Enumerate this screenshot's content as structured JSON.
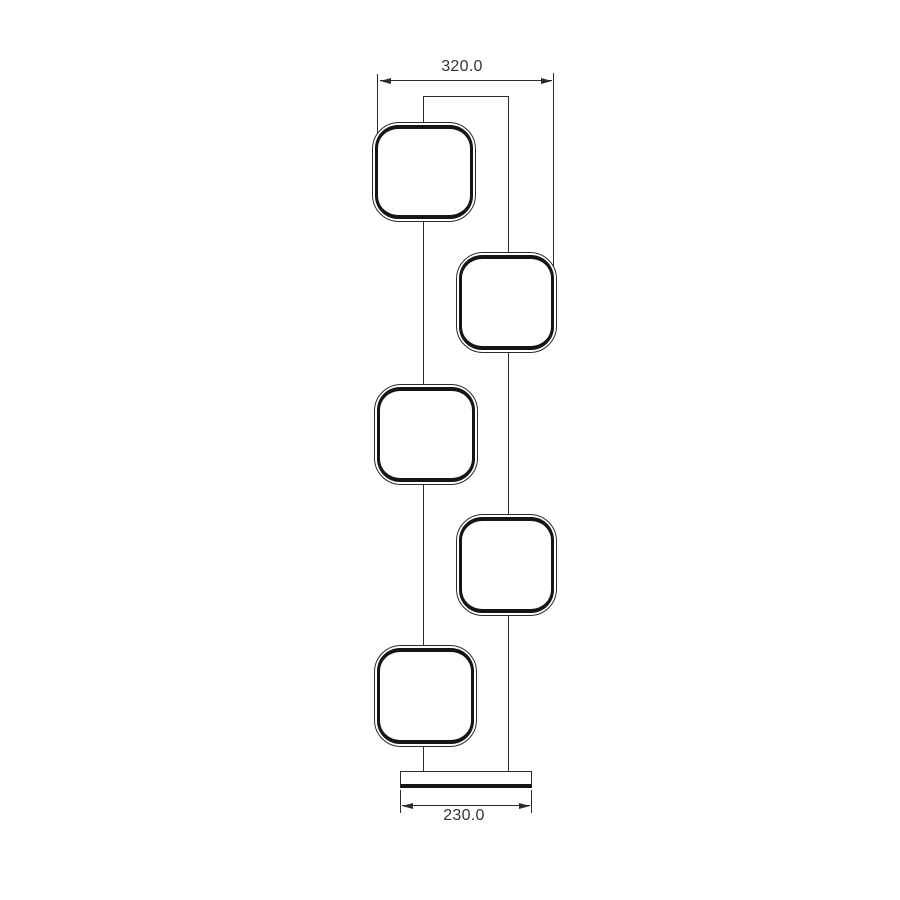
{
  "drawing": {
    "kind": "floor-lamp-dimension-drawing",
    "dimensions": {
      "overall_width": {
        "label": "320.0"
      },
      "base_width": {
        "label": "230.0"
      }
    },
    "head_count": 5,
    "colors": {
      "line": "#2b2b2b",
      "thick_line": "#151515",
      "text": "#333333",
      "background": "#ffffff"
    }
  }
}
